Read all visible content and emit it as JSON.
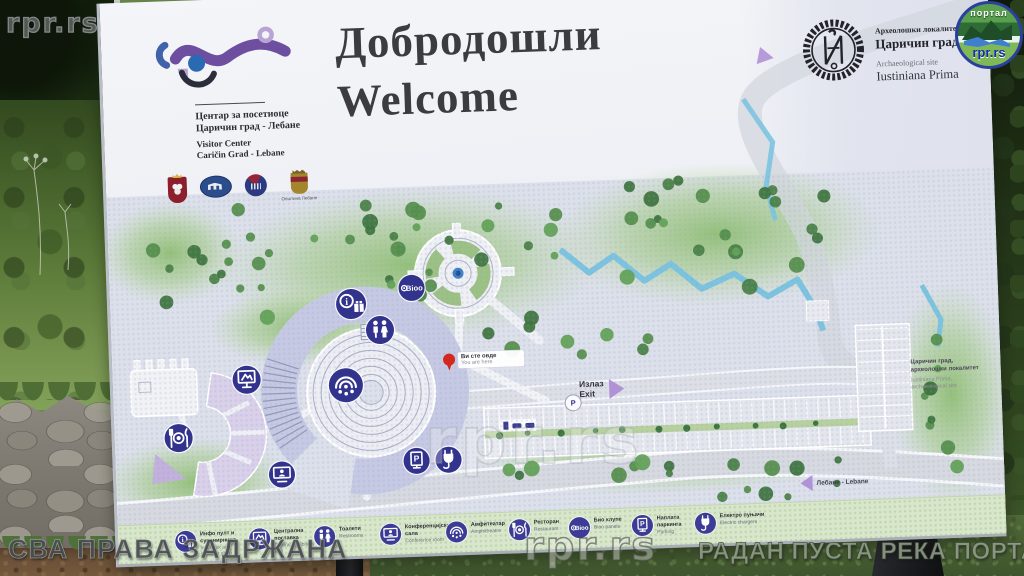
{
  "watermarks": {
    "top_left": "rpr.rs",
    "center": "rpr.rs",
    "bottom_center": "rpr.rs",
    "bottom_left": "СВА ПРАВА ЗАДРЖАНА",
    "bottom_right": "РАДАН ПУСТА РЕКА ПОРТАЛ",
    "badge": {
      "top": "портал",
      "bottom": "rpr.rs"
    }
  },
  "sign": {
    "header": {
      "visitor_center": {
        "line1_sr": "Центар за посетиоце",
        "line2_sr": "Царичин град - Лебане",
        "line1_en": "Visitor Center",
        "line2_en": "Caričin Grad - Lebane"
      },
      "title_sr": "Добродошли",
      "title_en": "Welcome",
      "site": {
        "line1_sr": "Археолошки локалитет",
        "line2_sr": "Царичин град",
        "line1_en": "Archaeological site",
        "line2_en": "Iustiniana Prima"
      },
      "partners": {
        "lebane_caption": "Општина Лебане"
      }
    },
    "map": {
      "bioo_badge": "Bioo",
      "you_are_here_sr": "Ви сте овде",
      "you_are_here_en": "You are here",
      "exit_sr": "Излаз",
      "exit_en": "Exit",
      "parking_symbol": "P",
      "site_label_sr": "Царичин град,",
      "site_label_sr2": "археолошки локалитет",
      "site_label_en": "Iustiniana Prima,",
      "site_label_en2": "archaeological site",
      "road_label": "Лебане - Lebane",
      "markers": [
        {
          "icon": "info-souvenir",
          "x": 241,
          "y": 309
        },
        {
          "icon": "restrooms",
          "x": 269,
          "y": 336
        },
        {
          "icon": "exhibition",
          "x": 134,
          "y": 381
        },
        {
          "icon": "amphitheatre",
          "x": 233,
          "y": 390
        },
        {
          "icon": "restaurant",
          "x": 64,
          "y": 437
        },
        {
          "icon": "conference",
          "x": 166,
          "y": 477
        },
        {
          "icon": "parking-pay",
          "x": 301,
          "y": 468
        },
        {
          "icon": "ev-charger",
          "x": 333,
          "y": 468
        },
        {
          "icon": "bioo",
          "x": 302,
          "y": 295
        },
        {
          "icon": "parking-p",
          "x": 459,
          "y": 415
        }
      ]
    },
    "legend": {
      "items": [
        {
          "icon": "info-souvenir",
          "sr": "Инфо пулт и сувенирница",
          "en": "Info desk and souvenir shop"
        },
        {
          "icon": "exhibition",
          "sr": "Централна поставка",
          "en": "Central Exhibition Hall"
        },
        {
          "icon": "restrooms",
          "sr": "Тоалети",
          "en": "Restrooms"
        },
        {
          "icon": "conference",
          "sr": "Конференцијска сала",
          "en": "Conference room"
        },
        {
          "icon": "amphitheatre",
          "sr": "Амфитеатар",
          "en": "Amphitheatre"
        },
        {
          "icon": "restaurant",
          "sr": "Ресторан",
          "en": "Restaurant"
        },
        {
          "icon": "bioo",
          "sr": "Био клупе",
          "en": "Bioo panels"
        },
        {
          "icon": "parking-pay",
          "sr": "Наплата паркинга",
          "en": "Parking"
        },
        {
          "icon": "ev-charger",
          "sr": "Електро пуњачи",
          "en": "Electric chargers"
        }
      ]
    }
  }
}
